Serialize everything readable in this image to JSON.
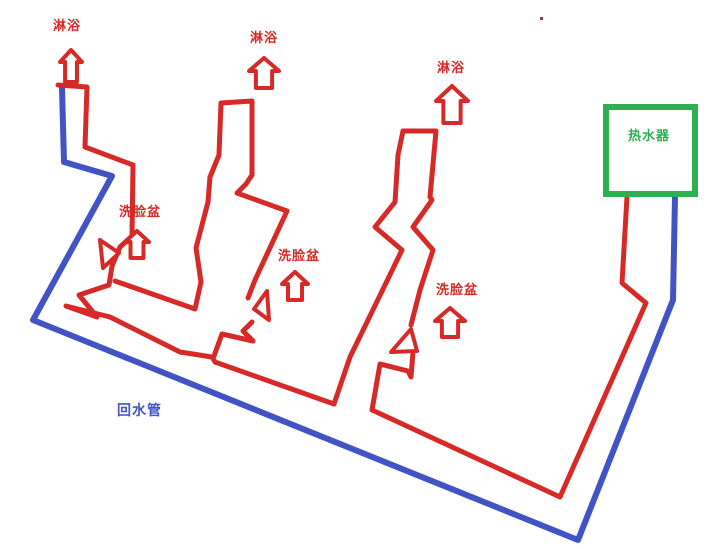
{
  "canvas": {
    "width": 718,
    "height": 549,
    "background": "#ffffff"
  },
  "colors": {
    "hot_pipe_red": "#d62a28",
    "return_pipe_blue": "#4253c4",
    "heater_green": "#2fae52",
    "stray_dot": "#8d4136",
    "arrow_fill": "#ffffff"
  },
  "labels": [
    {
      "id": "shower-1",
      "text": "淋浴",
      "x": 53,
      "y": 20,
      "color": "hot_pipe_red",
      "size": 13
    },
    {
      "id": "shower-2",
      "text": "淋浴",
      "x": 250,
      "y": 32,
      "color": "hot_pipe_red",
      "size": 13
    },
    {
      "id": "shower-3",
      "text": "淋浴",
      "x": 437,
      "y": 62,
      "color": "hot_pipe_red",
      "size": 13
    },
    {
      "id": "basin-1",
      "text": "洗脸盆",
      "x": 119,
      "y": 206,
      "color": "hot_pipe_red",
      "size": 13
    },
    {
      "id": "basin-2",
      "text": "洗脸盆",
      "x": 278,
      "y": 250,
      "color": "hot_pipe_red",
      "size": 13
    },
    {
      "id": "basin-3",
      "text": "洗脸盆",
      "x": 436,
      "y": 284,
      "color": "hot_pipe_red",
      "size": 13
    },
    {
      "id": "heater",
      "text": "热水器",
      "x": 628,
      "y": 130,
      "color": "heater_green",
      "size": 13
    },
    {
      "id": "return-pipe",
      "text": "回水管",
      "x": 117,
      "y": 404,
      "color": "return_pipe_blue",
      "size": 14
    }
  ],
  "heater_box": {
    "x": 606,
    "y": 107,
    "width": 89,
    "height": 87,
    "stroke_width": 6
  },
  "stray_dot": {
    "x": 540,
    "y": 17,
    "size": 3
  },
  "pipes": {
    "return": [
      {
        "name": "return-pipe-main",
        "points": [
          [
            62,
            88
          ],
          [
            64,
            162
          ],
          [
            112,
            176
          ],
          [
            33,
            320
          ],
          [
            578,
            540
          ],
          [
            673,
            300
          ],
          [
            675,
            197
          ]
        ]
      }
    ],
    "hot": [
      {
        "name": "hot-pipe-group1-and-main",
        "points": [
          [
            58,
            85
          ],
          [
            87,
            87
          ],
          [
            85,
            147
          ],
          [
            133,
            165
          ],
          [
            132,
            236
          ],
          [
            120,
            247
          ],
          [
            112,
            266
          ],
          [
            109,
            285
          ],
          [
            79,
            295
          ],
          [
            97,
            317
          ],
          [
            66,
            306
          ],
          [
            110,
            317
          ],
          [
            180,
            352
          ],
          [
            212,
            357
          ],
          [
            215,
            362
          ],
          [
            334,
            404
          ]
        ]
      },
      {
        "name": "hot-pipe-basin1-link",
        "points": [
          [
            115,
            281
          ],
          [
            195,
            309
          ],
          [
            201,
            282
          ]
        ]
      },
      {
        "name": "hot-pipe-group2-loop",
        "points": [
          [
            201,
            282
          ],
          [
            196,
            248
          ],
          [
            208,
            202
          ],
          [
            210,
            177
          ],
          [
            219,
            155
          ],
          [
            221,
            103
          ],
          [
            252,
            101
          ],
          [
            252,
            175
          ],
          [
            246,
            184
          ],
          [
            237,
            193
          ],
          [
            287,
            211
          ],
          [
            255,
            280
          ],
          [
            248,
            298
          ]
        ]
      },
      {
        "name": "hot-pipe-basin2-drop",
        "points": [
          [
            252,
            322
          ],
          [
            243,
            331
          ],
          [
            253,
            341
          ],
          [
            222,
            334
          ],
          [
            214,
            356
          ]
        ]
      },
      {
        "name": "hot-pipe-group3-loop",
        "points": [
          [
            334,
            404
          ],
          [
            350,
            357
          ],
          [
            368,
            320
          ],
          [
            402,
            250
          ],
          [
            375,
            227
          ],
          [
            395,
            202
          ],
          [
            398,
            155
          ],
          [
            403,
            131
          ],
          [
            436,
            131
          ],
          [
            430,
            197
          ],
          [
            432,
            200
          ],
          [
            413,
            227
          ],
          [
            433,
            250
          ],
          [
            420,
            290
          ],
          [
            411,
            325
          ]
        ]
      },
      {
        "name": "hot-pipe-basin3-to-heater",
        "points": [
          [
            413,
            352
          ],
          [
            411,
            377
          ],
          [
            408,
            371
          ],
          [
            380,
            364
          ],
          [
            372,
            410
          ],
          [
            560,
            497
          ],
          [
            646,
            303
          ],
          [
            622,
            283
          ],
          [
            627,
            197
          ]
        ]
      }
    ]
  },
  "valves": [
    {
      "name": "basin1-valve",
      "points": [
        [
          100,
          240
        ],
        [
          119,
          253
        ],
        [
          103,
          268
        ]
      ]
    },
    {
      "name": "basin2-valve",
      "points": [
        [
          267,
          291
        ],
        [
          254,
          309
        ],
        [
          269,
          320
        ]
      ]
    },
    {
      "name": "basin3-valve",
      "points": [
        [
          391,
          352
        ],
        [
          411,
          329
        ],
        [
          417,
          351
        ]
      ]
    }
  ],
  "flow_arrows": [
    {
      "name": "shower1-flow-arrow",
      "cx": 71,
      "tip": 50,
      "base": 82,
      "w": 22,
      "head": 12
    },
    {
      "name": "shower2-flow-arrow",
      "cx": 264,
      "tip": 58,
      "base": 88,
      "w": 30,
      "head": 13
    },
    {
      "name": "shower3-flow-arrow",
      "cx": 452,
      "tip": 86,
      "base": 123,
      "w": 32,
      "head": 15
    },
    {
      "name": "basin1-flow-arrow",
      "cx": 137,
      "tip": 231,
      "base": 258,
      "w": 24,
      "head": 11
    },
    {
      "name": "basin2-flow-arrow",
      "cx": 295,
      "tip": 272,
      "base": 300,
      "w": 26,
      "head": 12
    },
    {
      "name": "basin3-flow-arrow",
      "cx": 450,
      "tip": 308,
      "base": 337,
      "w": 30,
      "head": 13
    }
  ]
}
